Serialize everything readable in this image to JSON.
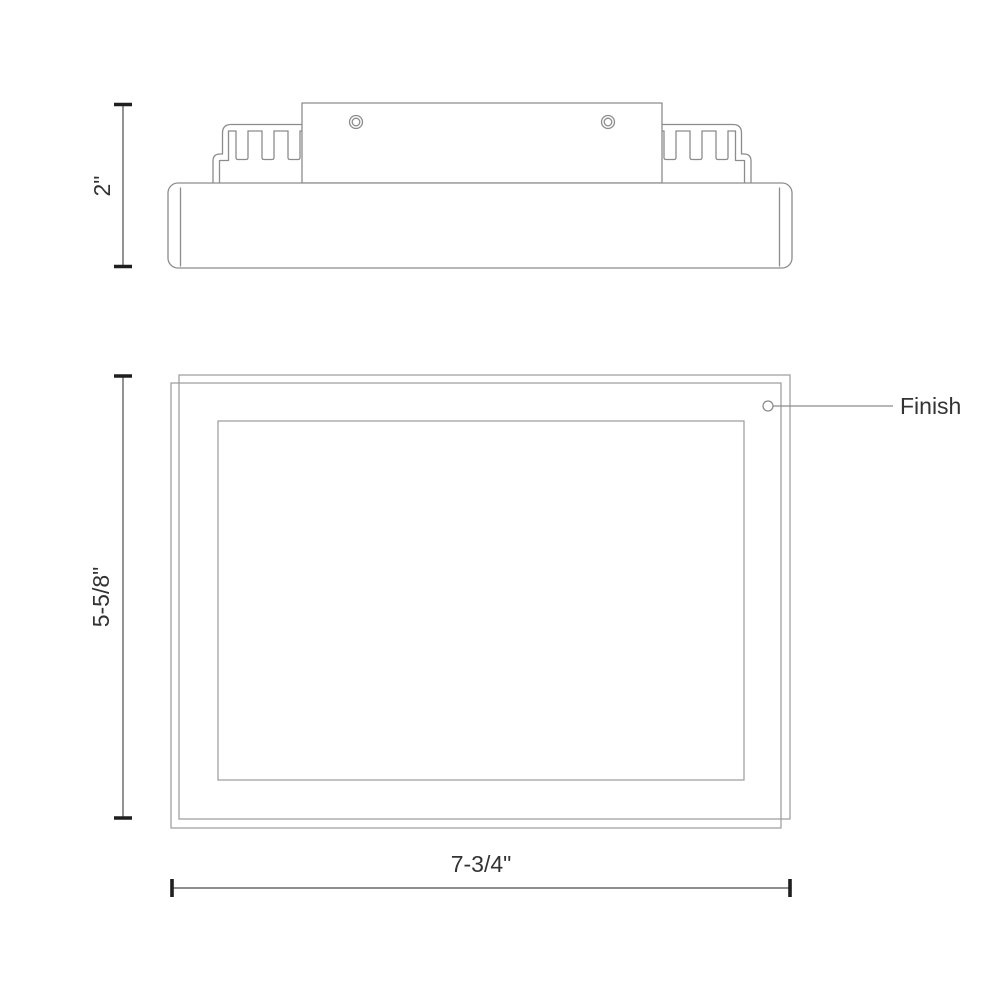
{
  "drawing": {
    "type": "technical-drawing",
    "product": "rectangular flush mount fixture, side elevation and bottom plan views",
    "colors": {
      "line": "#8c8c8c",
      "thin_line": "#9a9a9a",
      "dimension": "#4a4a4a",
      "tick": "#1f1f1f",
      "text": "#333333",
      "background": "#ffffff"
    },
    "side_view": {
      "height_dimension": {
        "label": "2\""
      }
    },
    "plan_view": {
      "height_dimension": {
        "label": "5-5/8\""
      },
      "width_dimension": {
        "label": "7-3/4\""
      },
      "finish_callout": {
        "label": "Finish"
      }
    }
  }
}
